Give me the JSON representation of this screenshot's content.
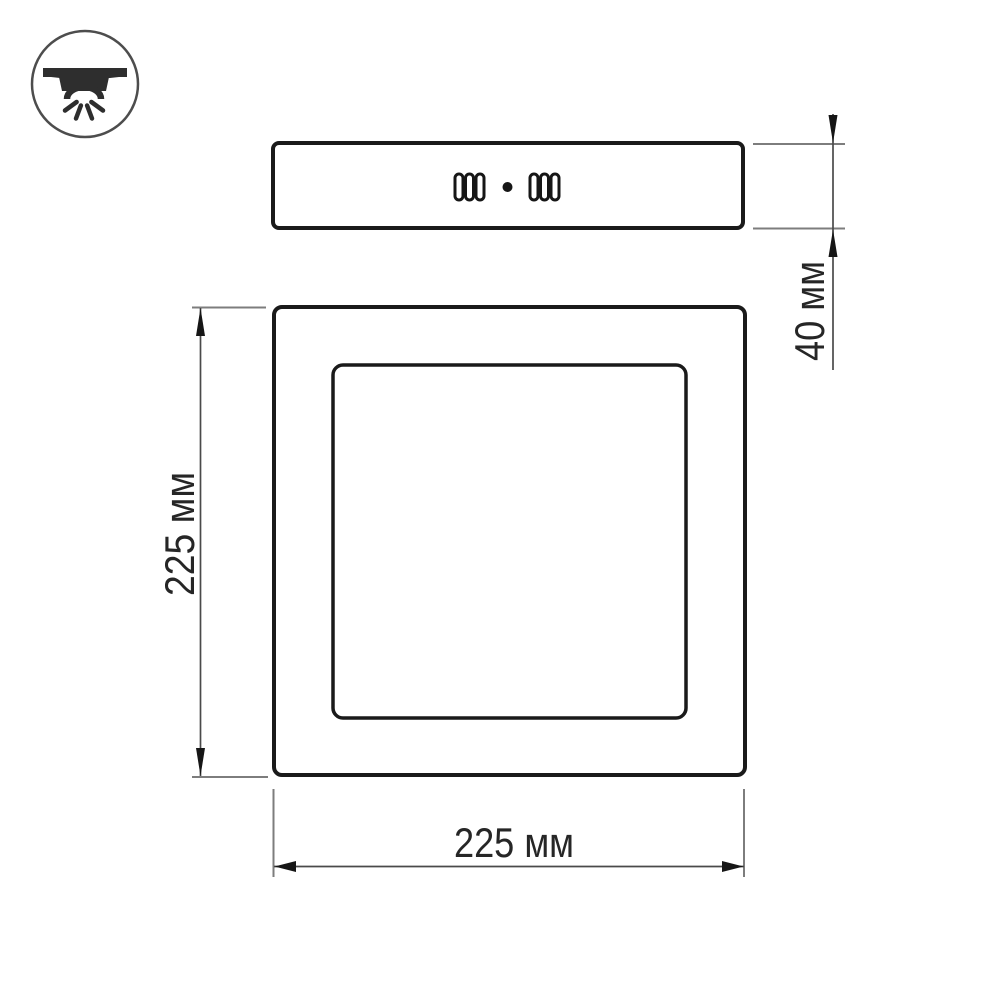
{
  "drawing": {
    "kind": "technical-dimension-diagram",
    "icon": {
      "name": "surface-mounted-downlight-icon"
    },
    "side_view": {
      "slot_groups": 2,
      "slots_per_group": 3,
      "center_dot": true
    },
    "front_view": {
      "outer_shape": "square-frame",
      "inner_shape": "square-diffuser"
    },
    "dimensions": {
      "height": {
        "label": "40 мм",
        "orientation": "vertical-right"
      },
      "side": {
        "label": "225 мм",
        "orientation": "vertical-left"
      },
      "width": {
        "label": "225 мм",
        "orientation": "horizontal-bottom"
      }
    },
    "colors": {
      "outline": "#1a1a1a",
      "dimension_line": "#4a4a4a",
      "extension_line": "#7d7d7d",
      "text": "#262626",
      "icon": "#2e2e2e",
      "background": "#ffffff"
    }
  }
}
